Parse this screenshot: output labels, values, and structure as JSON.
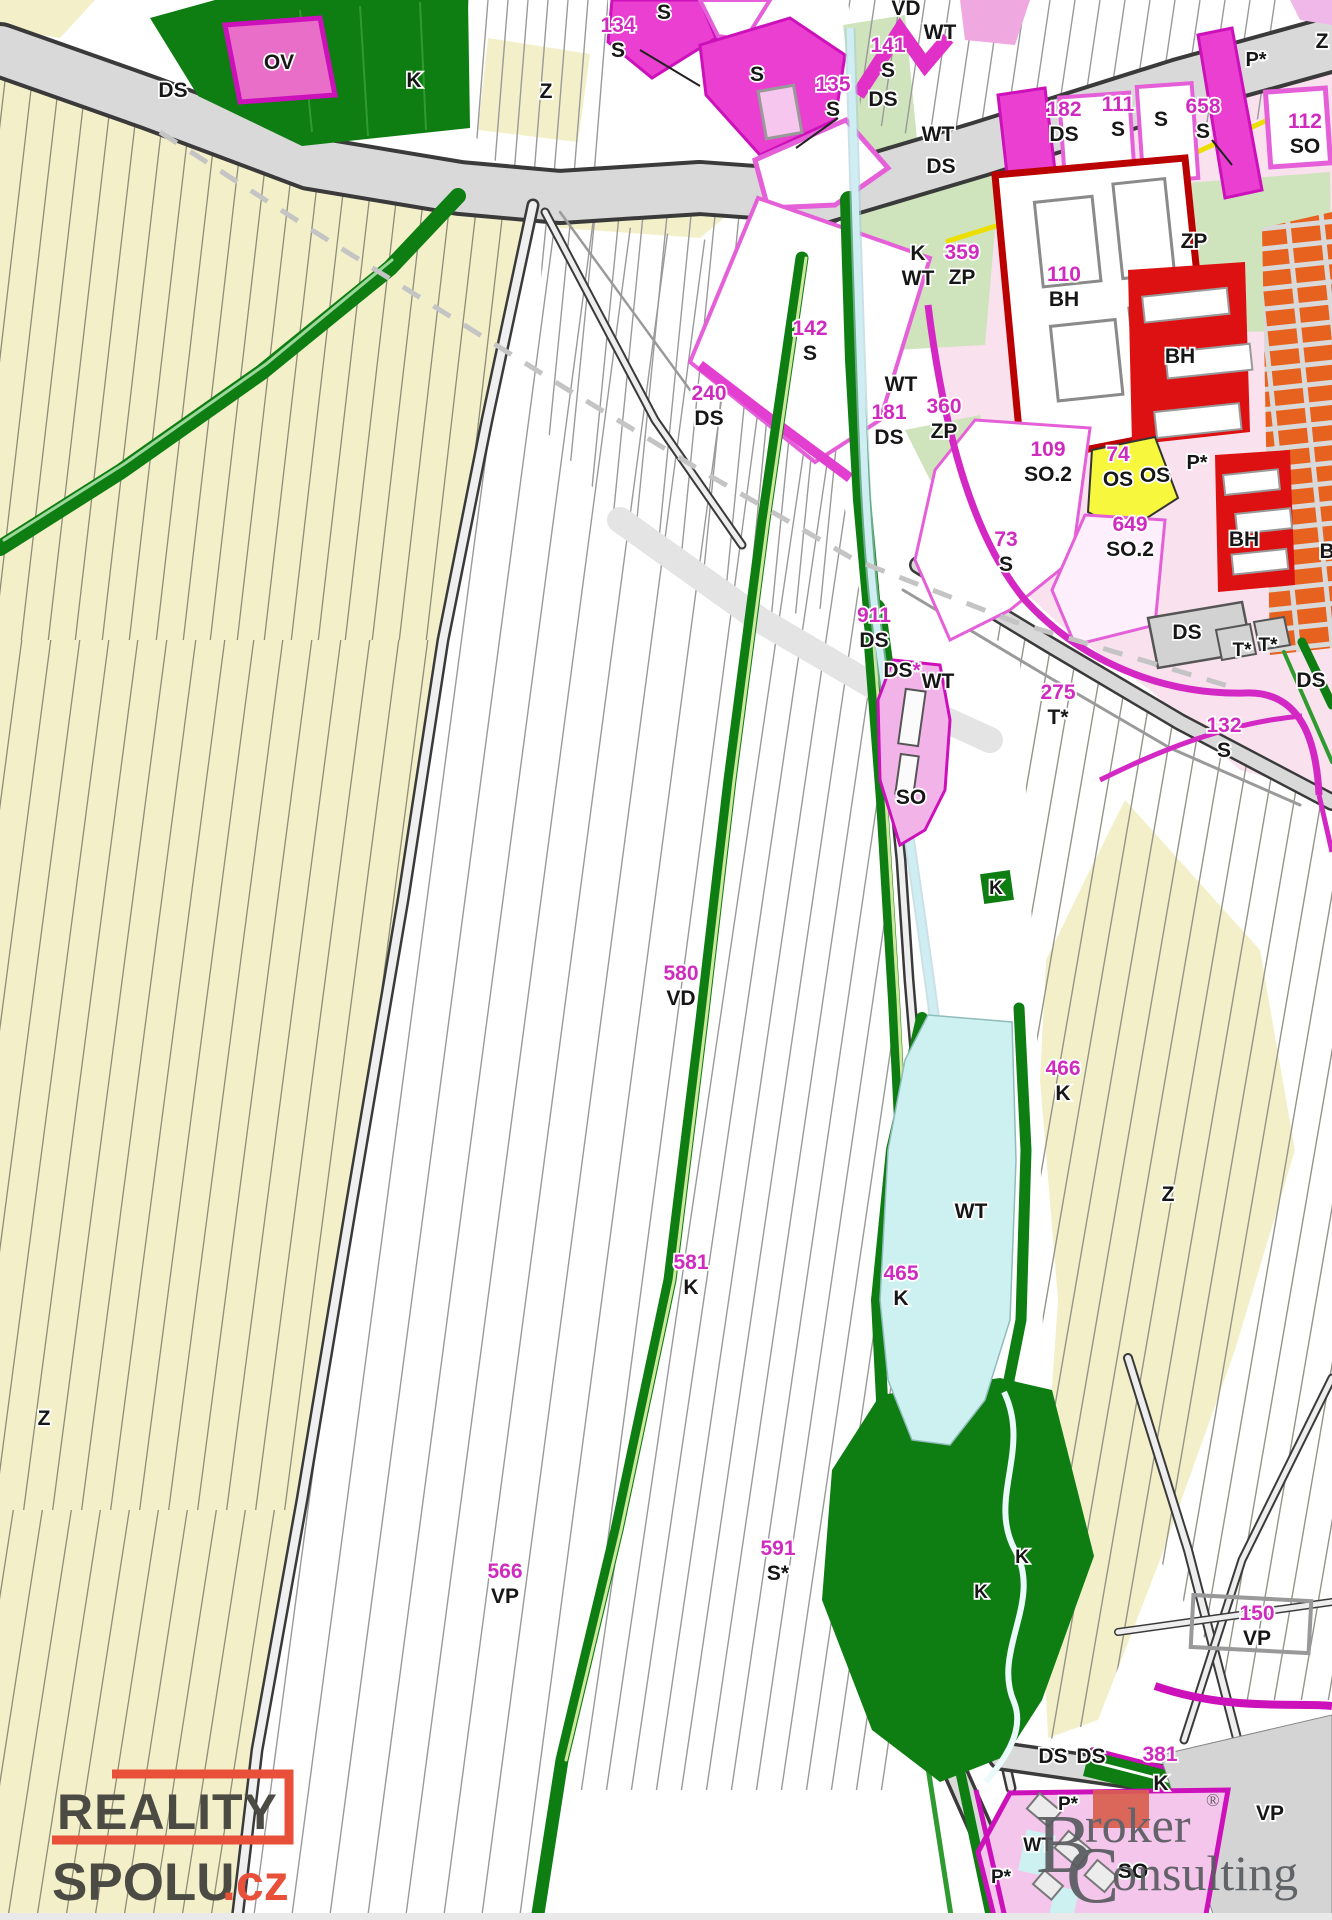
{
  "map": {
    "kind": "zoning-map",
    "colors": {
      "label_magenta": "#cf2bbf",
      "label_black": "#161616",
      "field_yellow": "#f3f0c9",
      "road_gray": "#d9d9d9",
      "dark_green": "#0e7d12",
      "light_green_zp": "#cfe3bc",
      "bright_magenta_s": "#ea3fd0",
      "light_pink_zone": "#f9e2ee",
      "pink_so": "#f2b4e8",
      "red_bh": "#dd1111",
      "orange_block": "#e8621f",
      "yellow_os": "#f7f73e",
      "water_cyan": "#cdf0f0",
      "magenta_border": "#d428c4"
    },
    "labels": [
      {
        "x": 173,
        "y": 97,
        "l": [
          [
            "k:DS"
          ]
        ]
      },
      {
        "x": 279,
        "y": 69,
        "l": [
          [
            "k:OV"
          ]
        ]
      },
      {
        "x": 414,
        "y": 87,
        "l": [
          [
            "k:K"
          ]
        ]
      },
      {
        "x": 546,
        "y": 98,
        "l": [
          [
            "k:Z"
          ]
        ]
      },
      {
        "x": 618,
        "y": 32,
        "l": [
          [
            "m:134"
          ],
          [
            "k:S"
          ]
        ]
      },
      {
        "x": 664,
        "y": 19,
        "l": [
          [
            "k:S"
          ]
        ]
      },
      {
        "x": 757,
        "y": 81,
        "l": [
          [
            "k:S"
          ]
        ]
      },
      {
        "x": 833,
        "y": 91,
        "l": [
          [
            "m:135"
          ],
          [
            "k:S"
          ]
        ]
      },
      {
        "x": 888,
        "y": 52,
        "l": [
          [
            "m:141"
          ],
          [
            "k:S"
          ]
        ]
      },
      {
        "x": 906,
        "y": 15,
        "l": [
          [
            "k:VD"
          ]
        ]
      },
      {
        "x": 940,
        "y": 39,
        "l": [
          [
            "k:WT"
          ]
        ]
      },
      {
        "x": 883,
        "y": 106,
        "l": [
          [
            "k:DS"
          ]
        ]
      },
      {
        "x": 938,
        "y": 141,
        "l": [
          [
            "k:WT"
          ]
        ]
      },
      {
        "x": 941,
        "y": 173,
        "l": [
          [
            "k:DS"
          ]
        ]
      },
      {
        "x": 1064,
        "y": 116,
        "l": [
          [
            "m:182"
          ],
          [
            "k:DS"
          ]
        ]
      },
      {
        "x": 1118,
        "y": 111,
        "l": [
          [
            "m:111"
          ],
          [
            "k:S"
          ]
        ]
      },
      {
        "x": 1161,
        "y": 126,
        "l": [
          [
            "k:S"
          ]
        ]
      },
      {
        "x": 1203,
        "y": 113,
        "l": [
          [
            "m:658"
          ],
          [
            "k:S"
          ]
        ]
      },
      {
        "x": 1256,
        "y": 66,
        "l": [
          [
            "k:P*"
          ]
        ],
        "size": 20
      },
      {
        "x": 1322,
        "y": 48,
        "l": [
          [
            "k:Z"
          ]
        ]
      },
      {
        "x": 1305,
        "y": 128,
        "l": [
          [
            "m:112"
          ],
          [
            "k:SO"
          ]
        ]
      },
      {
        "x": 918,
        "y": 260,
        "l": [
          [
            "k:K"
          ],
          [
            "k:WT"
          ]
        ]
      },
      {
        "x": 962,
        "y": 259,
        "l": [
          [
            "m:359"
          ],
          [
            "k:ZP"
          ]
        ]
      },
      {
        "x": 1064,
        "y": 281,
        "l": [
          [
            "m:110"
          ],
          [
            "k:BH"
          ]
        ]
      },
      {
        "x": 1194,
        "y": 248,
        "l": [
          [
            "k:ZP"
          ]
        ]
      },
      {
        "x": 1180,
        "y": 363,
        "l": [
          [
            "k:BH"
          ]
        ]
      },
      {
        "x": 810,
        "y": 335,
        "l": [
          [
            "m:142"
          ],
          [
            "k:S"
          ]
        ]
      },
      {
        "x": 709,
        "y": 400,
        "l": [
          [
            "m:240"
          ],
          [
            "k:DS"
          ]
        ]
      },
      {
        "x": 901,
        "y": 391,
        "l": [
          [
            "k:WT"
          ]
        ]
      },
      {
        "x": 889,
        "y": 419,
        "l": [
          [
            "m:181"
          ],
          [
            "k:DS"
          ]
        ]
      },
      {
        "x": 944,
        "y": 413,
        "l": [
          [
            "m:360"
          ],
          [
            "k:ZP"
          ]
        ]
      },
      {
        "x": 1048,
        "y": 456,
        "l": [
          [
            "m:109"
          ],
          [
            "k:SO.2"
          ]
        ]
      },
      {
        "x": 1118,
        "y": 461,
        "l": [
          [
            "m:74"
          ],
          [
            "k:OS"
          ]
        ]
      },
      {
        "x": 1155,
        "y": 482,
        "l": [
          [
            "k:OS"
          ]
        ]
      },
      {
        "x": 1197,
        "y": 469,
        "l": [
          [
            "k:P*"
          ]
        ],
        "size": 20
      },
      {
        "x": 1130,
        "y": 531,
        "l": [
          [
            "m:649"
          ],
          [
            "k:SO.2"
          ]
        ]
      },
      {
        "x": 1006,
        "y": 546,
        "l": [
          [
            "m:73"
          ],
          [
            "k:S"
          ]
        ]
      },
      {
        "x": 1244,
        "y": 546,
        "l": [
          [
            "k:BH"
          ]
        ]
      },
      {
        "x": 1330,
        "y": 558,
        "l": [
          [
            "k:BI"
          ]
        ]
      },
      {
        "x": 1187,
        "y": 639,
        "l": [
          [
            "k:DS"
          ]
        ]
      },
      {
        "x": 1242,
        "y": 656,
        "l": [
          [
            "k:T*"
          ]
        ],
        "size": 19
      },
      {
        "x": 1268,
        "y": 651,
        "l": [
          [
            "k:T*"
          ]
        ],
        "size": 19
      },
      {
        "x": 1311,
        "y": 687,
        "l": [
          [
            "k:DS"
          ]
        ]
      },
      {
        "x": 1224,
        "y": 732,
        "l": [
          [
            "m:132"
          ],
          [
            "k:S"
          ]
        ]
      },
      {
        "x": 874,
        "y": 622,
        "l": [
          [
            "m:911"
          ],
          [
            "k:DS"
          ]
        ]
      },
      {
        "x": 902,
        "y": 677,
        "l": [
          [
            "k:DS",
            "m:*"
          ]
        ]
      },
      {
        "x": 938,
        "y": 688,
        "l": [
          [
            "k:WT"
          ]
        ]
      },
      {
        "x": 1058,
        "y": 699,
        "l": [
          [
            "m:275"
          ],
          [
            "k:T*"
          ]
        ]
      },
      {
        "x": 911,
        "y": 804,
        "l": [
          [
            "k:SO"
          ]
        ]
      },
      {
        "x": 996,
        "y": 894,
        "l": [
          [
            "k:K"
          ]
        ],
        "size": 19
      },
      {
        "x": 681,
        "y": 980,
        "l": [
          [
            "m:580"
          ],
          [
            "k:VD"
          ]
        ]
      },
      {
        "x": 1063,
        "y": 1075,
        "l": [
          [
            "m:466"
          ],
          [
            "k:K"
          ]
        ]
      },
      {
        "x": 1168,
        "y": 1201,
        "l": [
          [
            "k:Z"
          ]
        ]
      },
      {
        "x": 971,
        "y": 1218,
        "l": [
          [
            "k:WT"
          ]
        ]
      },
      {
        "x": 691,
        "y": 1269,
        "l": [
          [
            "m:581"
          ],
          [
            "k:K"
          ]
        ]
      },
      {
        "x": 901,
        "y": 1280,
        "l": [
          [
            "m:465"
          ],
          [
            "k:K"
          ]
        ]
      },
      {
        "x": 44,
        "y": 1425,
        "l": [
          [
            "k:Z"
          ]
        ]
      },
      {
        "x": 505,
        "y": 1578,
        "l": [
          [
            "m:566"
          ],
          [
            "k:VP"
          ]
        ]
      },
      {
        "x": 778,
        "y": 1555,
        "l": [
          [
            "m:591"
          ],
          [
            "k:S*"
          ]
        ]
      },
      {
        "x": 1022,
        "y": 1563,
        "l": [
          [
            "k:K"
          ]
        ],
        "size": 19
      },
      {
        "x": 981,
        "y": 1598,
        "l": [
          [
            "k:K"
          ]
        ],
        "size": 19
      },
      {
        "x": 1257,
        "y": 1620,
        "l": [
          [
            "m:150"
          ],
          [
            "k:VP"
          ]
        ]
      },
      {
        "x": 1053,
        "y": 1763,
        "l": [
          [
            "k:DS"
          ]
        ]
      },
      {
        "x": 1091,
        "y": 1763,
        "l": [
          [
            "k:DS"
          ]
        ]
      },
      {
        "x": 1160,
        "y": 1761,
        "l": [
          [
            "m:381"
          ]
        ]
      },
      {
        "x": 1161,
        "y": 1790,
        "l": [
          [
            "k:K"
          ]
        ]
      },
      {
        "x": 1068,
        "y": 1810,
        "l": [
          [
            "k:P*"
          ]
        ],
        "size": 19
      },
      {
        "x": 1038,
        "y": 1851,
        "l": [
          [
            "k:WT"
          ]
        ],
        "size": 19
      },
      {
        "x": 1001,
        "y": 1883,
        "l": [
          [
            "k:P*"
          ]
        ],
        "size": 19
      },
      {
        "x": 1133,
        "y": 1878,
        "l": [
          [
            "k:SO"
          ]
        ]
      },
      {
        "x": 1270,
        "y": 1820,
        "l": [
          [
            "k:VP"
          ]
        ]
      }
    ]
  },
  "watermarks": {
    "reality": {
      "line1": "REALITY",
      "line2": "SPOLU",
      "tld": ".cz"
    },
    "broker": {
      "b_initial": "B",
      "b_rest": "roker",
      "reg": "®",
      "c_initial": "C",
      "c_rest": "onsulting"
    }
  }
}
